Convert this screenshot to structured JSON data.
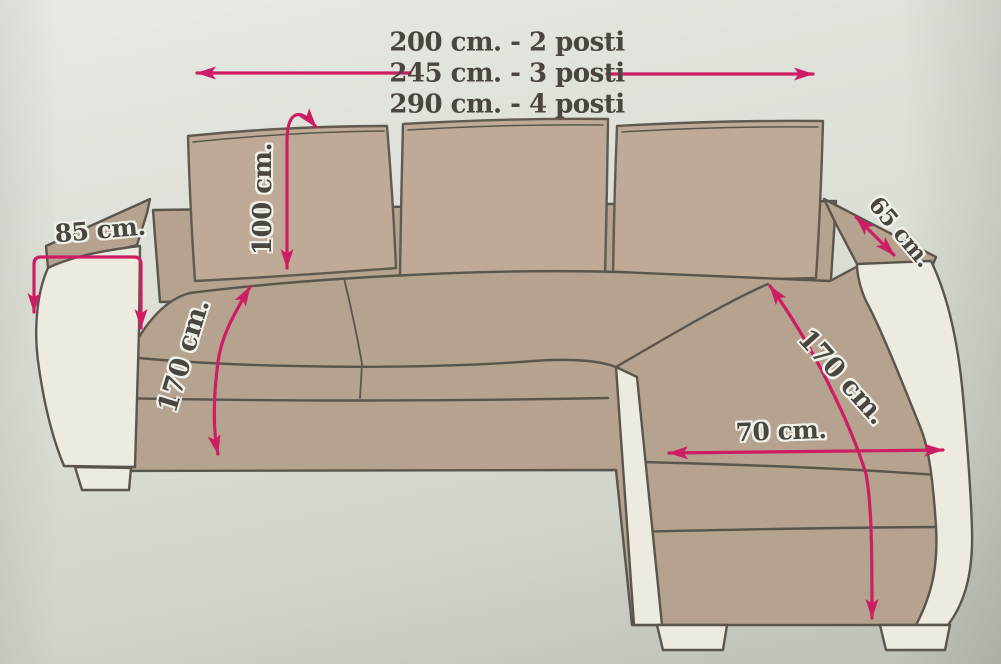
{
  "diagram": {
    "type": "corner-sofa-dimensions",
    "unit": "cm",
    "size_options": [
      {
        "text": "200 cm. - 2 posti",
        "length_cm": 200,
        "seats": 2
      },
      {
        "text": "245 cm. - 3 posti",
        "length_cm": 245,
        "seats": 3
      },
      {
        "text": "290 cm. - 4 posti",
        "length_cm": 290,
        "seats": 4
      }
    ],
    "measurements": {
      "back_height": {
        "text": "100 cm.",
        "value_cm": 100
      },
      "left_armrest_depth": {
        "text": "85 cm.",
        "value_cm": 85
      },
      "seat_depth_left": {
        "text": "170 cm.",
        "value_cm": 170
      },
      "right_armrest_depth": {
        "text": "65 cm.",
        "value_cm": 65
      },
      "chaise_length": {
        "text": "170 cm.",
        "value_cm": 170
      },
      "chaise_width": {
        "text": "70 cm.",
        "value_cm": 70
      }
    },
    "colors": {
      "background": "#dcdfd6",
      "sofa_fabric": "#b5a28f",
      "sofa_trim": "#edebdf",
      "outline": "#5b564d",
      "arrow": "#ce1e63",
      "label_text": "#4a463f"
    }
  }
}
